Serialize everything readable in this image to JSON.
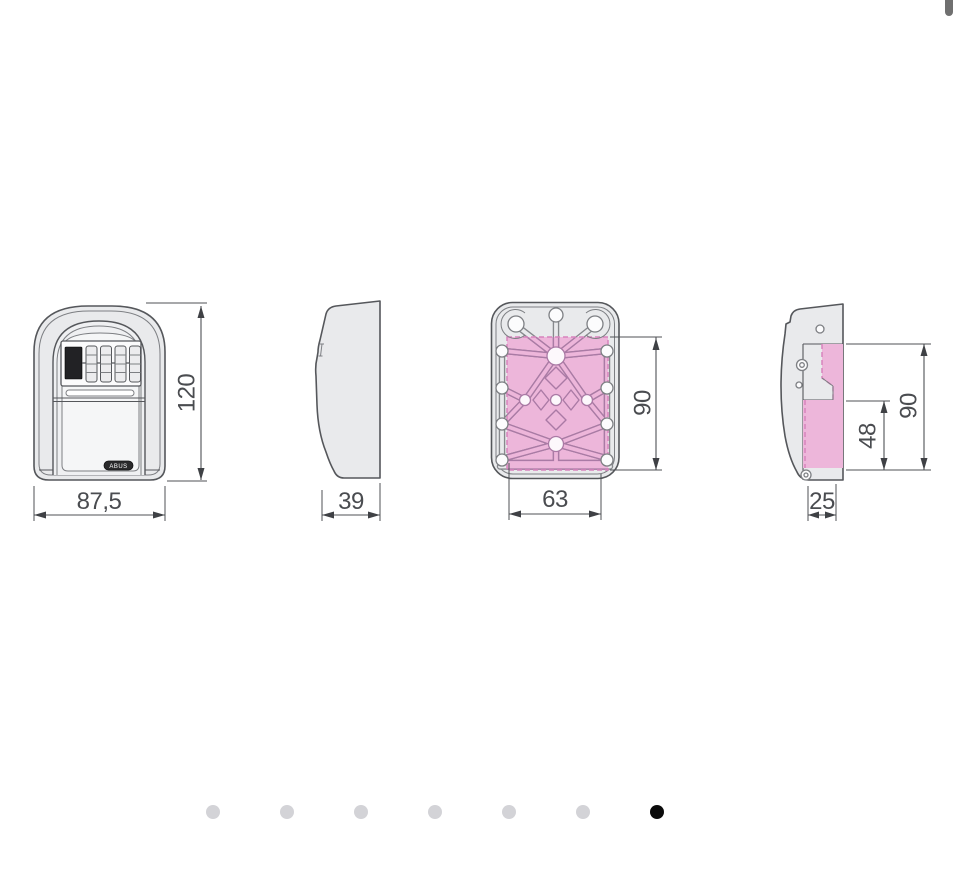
{
  "drawing": {
    "front": {
      "height_label": "120",
      "width_label": "87,5",
      "brand": "ABUS"
    },
    "side": {
      "depth_label": "39"
    },
    "back": {
      "height_label": "90",
      "width_label": "63"
    },
    "mount": {
      "height_label": "90",
      "inner_height_label": "48",
      "depth_label": "25"
    }
  },
  "carousel": {
    "dots": [
      "inactive",
      "inactive",
      "inactive",
      "inactive",
      "inactive",
      "inactive",
      "active"
    ],
    "active_index": 6,
    "active_color": "#0b0b0b",
    "inactive_color": "#d3d3d7"
  },
  "colors": {
    "outline": "#55575b",
    "dimension": "#4f5156",
    "body_fill": "#e9eaec",
    "highlight_pink": "#edb6da",
    "pink_outline": "#aa7aa5",
    "scrollbar": "#707070"
  }
}
